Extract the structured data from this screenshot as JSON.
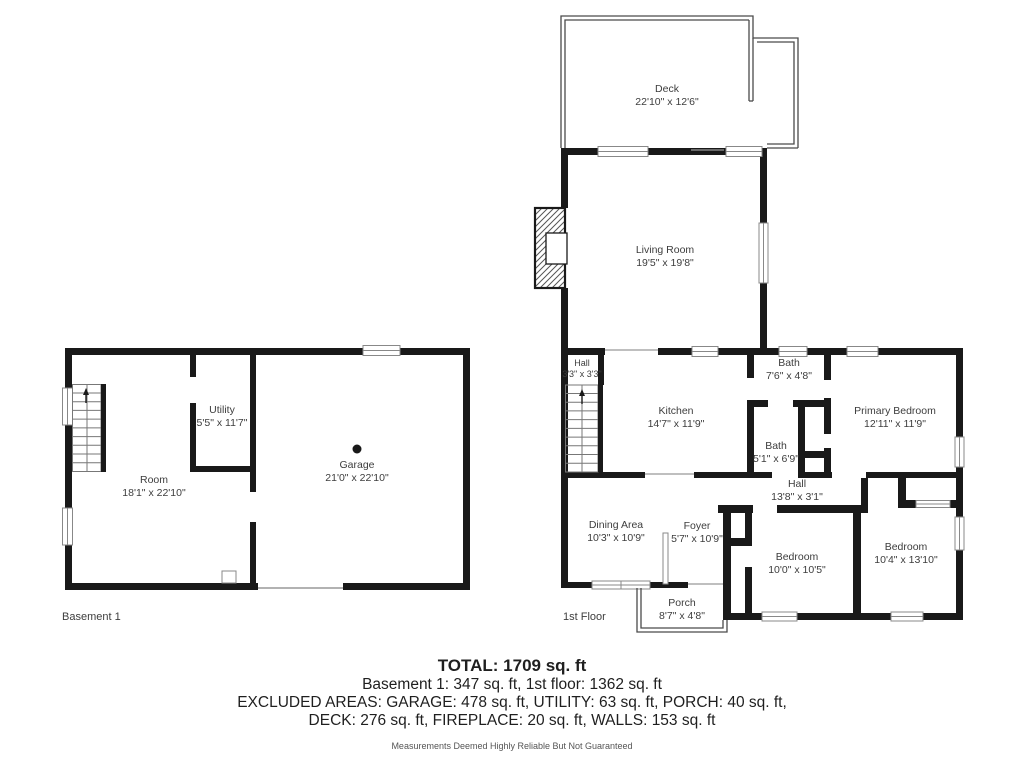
{
  "floors": {
    "basement_label": "Basement 1",
    "first_label": "1st Floor"
  },
  "rooms": {
    "deck": {
      "name": "Deck",
      "dims": "22'10\" x 12'6\""
    },
    "living": {
      "name": "Living Room",
      "dims": "19'5\" x 19'8\""
    },
    "hall1": {
      "name": "Hall",
      "dims": "3'3\" x 3'3\""
    },
    "kitchen": {
      "name": "Kitchen",
      "dims": "14'7\" x 11'9\""
    },
    "bath1": {
      "name": "Bath",
      "dims": "7'6\" x 4'8\""
    },
    "primary": {
      "name": "Primary Bedroom",
      "dims": "12'11\" x 11'9\""
    },
    "bath2": {
      "name": "Bath",
      "dims": "5'1\" x 6'9\""
    },
    "hall2": {
      "name": "Hall",
      "dims": "13'8\" x 3'1\""
    },
    "dining": {
      "name": "Dining Area",
      "dims": "10'3\" x 10'9\""
    },
    "foyer": {
      "name": "Foyer",
      "dims": "5'7\" x 10'9\""
    },
    "bedroom1": {
      "name": "Bedroom",
      "dims": "10'0\" x 10'5\""
    },
    "bedroom2": {
      "name": "Bedroom",
      "dims": "10'4\" x 13'10\""
    },
    "porch": {
      "name": "Porch",
      "dims": "8'7\" x 4'8\""
    },
    "b_room": {
      "name": "Room",
      "dims": "18'1\" x 22'10\""
    },
    "b_utility": {
      "name": "Utility",
      "dims": "5'5\" x 11'7\""
    },
    "b_garage": {
      "name": "Garage",
      "dims": "21'0\" x 22'10\""
    }
  },
  "summary": {
    "total": "TOTAL: 1709 sq. ft",
    "floors_line": "Basement 1: 347 sq. ft, 1st floor: 1362 sq. ft",
    "excluded_line1": "EXCLUDED AREAS: GARAGE: 478 sq. ft, UTILITY: 63 sq. ft, PORCH: 40 sq. ft,",
    "excluded_line2": "DECK: 276 sq. ft, FIREPLACE: 20 sq. ft, WALLS: 153 sq. ft",
    "disclaimer": "Measurements Deemed Highly Reliable But Not Guaranteed"
  },
  "colors": {
    "wall": "#191919",
    "thin_wall": "#4a4a4a",
    "window_stroke": "#888888"
  }
}
